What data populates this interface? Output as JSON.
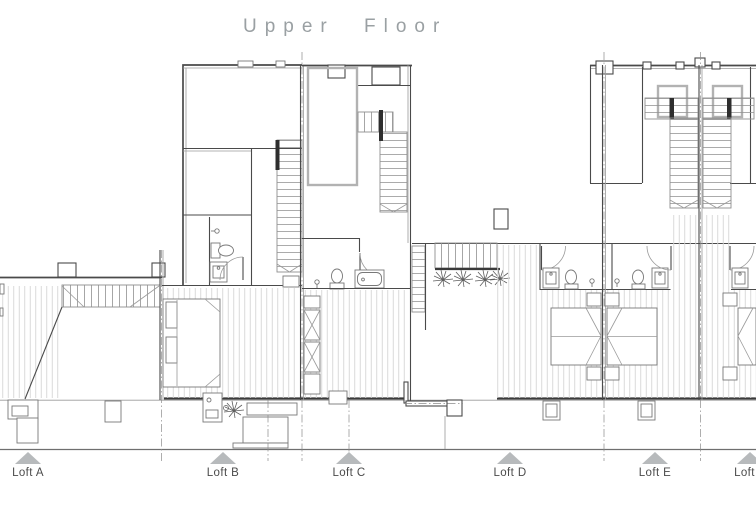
{
  "header": {
    "title": "Upper Floor"
  },
  "footer": {
    "markers": [
      {
        "label": "Loft A"
      },
      {
        "label": "Loft B"
      },
      {
        "label": "Loft C"
      },
      {
        "label": "Loft D"
      },
      {
        "label": "Loft E"
      },
      {
        "label": "Loft F"
      }
    ]
  },
  "colors": {
    "color-line": "#4a4a4a",
    "color-thin": "#9a9a9a",
    "color-hatch": "#d6d6d6",
    "color-fixture": "#787878",
    "color-dark": "#2e2e2e",
    "color-graywall": "#b2b2b2",
    "color-title": "#9aa0a3",
    "color-label": "#4b4b4b",
    "color-triangle": "#b7babc",
    "color-ground": "#6f6f6f",
    "color-dash": "#8c8c8c"
  }
}
